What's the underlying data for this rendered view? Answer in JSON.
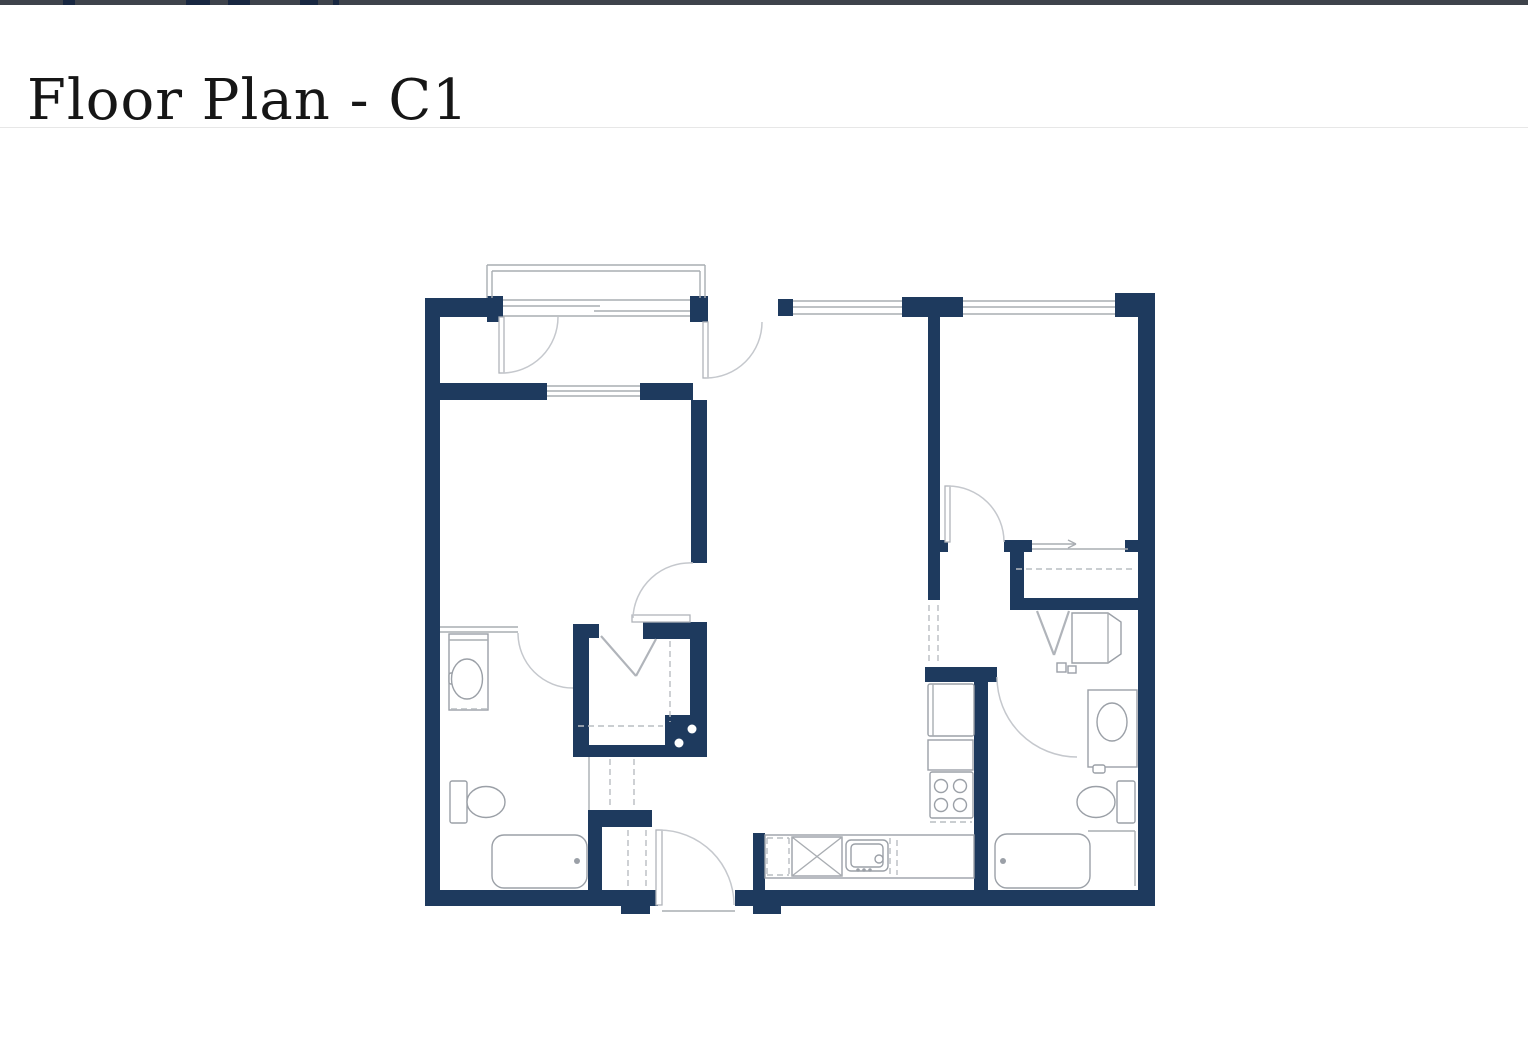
{
  "topbar": {
    "color": "#3e434b",
    "mark_color": "#182741",
    "marks": [
      [
        63,
        12
      ],
      [
        186,
        24
      ],
      [
        228,
        22
      ],
      [
        300,
        18
      ],
      [
        333,
        6
      ]
    ]
  },
  "header": {
    "title": "Floor Plan - C1"
  },
  "plan": {
    "colors": {
      "wall": "#1e3a5e",
      "line": "#a9adb2",
      "arc": "#c5c8cd",
      "dash": "#b9bdc2",
      "fixture": "#9ba0a7",
      "leaf": "#b0b4ba"
    },
    "walls": [
      [
        425,
        298,
        62,
        19
      ],
      [
        487,
        296,
        16,
        26
      ],
      [
        690,
        296,
        18,
        26
      ],
      [
        778,
        299,
        15,
        17
      ],
      [
        902,
        297,
        61,
        20
      ],
      [
        1115,
        293,
        40,
        24
      ],
      [
        425,
        298,
        15,
        608
      ],
      [
        1138,
        293,
        17,
        613
      ],
      [
        425,
        890,
        233,
        16
      ],
      [
        735,
        890,
        420,
        16
      ],
      [
        621,
        892,
        29,
        22
      ],
      [
        753,
        892,
        28,
        22
      ],
      [
        425,
        383,
        122,
        17
      ],
      [
        640,
        383,
        53,
        17
      ],
      [
        691,
        400,
        16,
        163
      ],
      [
        643,
        622,
        64,
        17
      ],
      [
        690,
        622,
        17,
        93
      ],
      [
        665,
        715,
        42,
        42
      ],
      [
        573,
        745,
        94,
        12
      ],
      [
        573,
        624,
        16,
        133
      ],
      [
        587,
        624,
        12,
        14
      ],
      [
        588,
        810,
        64,
        17
      ],
      [
        588,
        810,
        14,
        80
      ],
      [
        753,
        833,
        12,
        57
      ],
      [
        974,
        682,
        14,
        208
      ],
      [
        925,
        667,
        72,
        15
      ],
      [
        928,
        317,
        12,
        283
      ],
      [
        940,
        540,
        8,
        12
      ],
      [
        1004,
        540,
        28,
        12
      ],
      [
        1125,
        540,
        13,
        12
      ],
      [
        1010,
        552,
        14,
        58
      ],
      [
        1010,
        598,
        130,
        12
      ]
    ],
    "frects": [
      [
        449,
        634,
        39,
        76,
        0
      ],
      [
        449,
        673,
        8,
        11,
        2
      ],
      [
        450,
        781,
        17,
        42,
        2
      ],
      [
        492,
        835,
        95,
        53,
        12
      ],
      [
        765,
        835,
        209,
        43,
        0
      ],
      [
        792,
        837,
        50,
        39,
        0
      ],
      [
        846,
        840,
        42,
        31,
        5
      ],
      [
        851,
        844,
        32,
        23,
        4
      ],
      [
        928,
        684,
        46,
        52,
        2
      ],
      [
        928,
        740,
        45,
        30,
        0
      ],
      [
        930,
        772,
        43,
        46,
        2
      ],
      [
        1088,
        690,
        49,
        77,
        0
      ],
      [
        1093,
        765,
        12,
        8,
        2
      ],
      [
        1117,
        781,
        18,
        42,
        2
      ],
      [
        995,
        834,
        95,
        54,
        12
      ],
      [
        1057,
        663,
        9,
        9,
        0
      ],
      [
        1068,
        666,
        8,
        7,
        0
      ]
    ],
    "polys": [
      "1072,613 1108,613 1121,622 1121,654 1108,663 1072,663"
    ],
    "ellipses": [
      [
        467,
        679,
        15.5,
        20
      ],
      [
        486,
        802,
        19,
        15.5
      ],
      [
        1112,
        722,
        15,
        19
      ],
      [
        1096,
        802,
        19,
        15.5
      ],
      [
        941,
        786,
        6.5,
        6.5
      ],
      [
        960,
        786,
        6.5,
        6.5
      ],
      [
        941,
        805,
        6.5,
        6.5
      ],
      [
        960,
        805,
        6.5,
        6.5
      ],
      [
        879,
        859,
        4,
        4
      ]
    ],
    "leaves": [
      [
        632,
        615,
        58,
        7
      ],
      [
        656,
        830,
        6,
        75
      ],
      [
        499,
        317,
        5,
        56
      ],
      [
        703,
        322,
        5,
        56
      ],
      [
        945,
        486,
        5,
        56
      ]
    ],
    "lines": [
      [
        487,
        298,
        487,
        265
      ],
      [
        487,
        265,
        705,
        265
      ],
      [
        705,
        265,
        705,
        298
      ],
      [
        492,
        298,
        492,
        271
      ],
      [
        492,
        271,
        700,
        271
      ],
      [
        700,
        271,
        700,
        298
      ],
      [
        503,
        300,
        690,
        300
      ],
      [
        503,
        316,
        690,
        316
      ],
      [
        503,
        306,
        600,
        306
      ],
      [
        594,
        311,
        690,
        311
      ],
      [
        547,
        386,
        640,
        386
      ],
      [
        547,
        391,
        640,
        391
      ],
      [
        547,
        396,
        640,
        396
      ],
      [
        793,
        301,
        902,
        301
      ],
      [
        793,
        307,
        902,
        307
      ],
      [
        793,
        314,
        902,
        314
      ],
      [
        963,
        301,
        1115,
        301
      ],
      [
        963,
        307,
        1115,
        307
      ],
      [
        963,
        314,
        1115,
        314
      ],
      [
        440,
        627,
        518,
        627
      ],
      [
        440,
        632,
        518,
        632
      ],
      [
        589,
        757,
        589,
        810
      ],
      [
        1032,
        549,
        1128,
        549
      ],
      [
        1032,
        544,
        1076,
        544
      ],
      [
        1068,
        540,
        1076,
        544
      ],
      [
        1068,
        548,
        1076,
        544
      ],
      [
        1088,
        831,
        1135,
        831
      ],
      [
        1135,
        831,
        1135,
        886
      ],
      [
        662,
        911,
        735,
        911
      ],
      [
        792,
        837,
        842,
        876
      ],
      [
        842,
        837,
        792,
        876
      ],
      [
        933,
        684,
        933,
        736
      ],
      [
        1108,
        613,
        1108,
        663
      ],
      [
        449,
        640,
        488,
        640
      ]
    ],
    "vlines": [
      [
        601,
        636,
        636,
        676
      ],
      [
        636,
        676,
        656,
        639
      ],
      [
        1037,
        611,
        1054,
        655
      ],
      [
        1054,
        655,
        1069,
        611
      ]
    ],
    "dlines": [
      [
        929,
        605,
        929,
        665
      ],
      [
        938,
        605,
        938,
        665
      ],
      [
        578,
        726,
        663,
        726
      ],
      [
        670,
        641,
        670,
        722
      ],
      [
        1016,
        569,
        1135,
        569
      ],
      [
        610,
        759,
        610,
        808
      ],
      [
        634,
        759,
        634,
        808
      ],
      [
        628,
        830,
        628,
        888
      ],
      [
        646,
        830,
        646,
        888
      ],
      [
        451,
        709,
        487,
        709
      ],
      [
        890,
        838,
        890,
        875
      ],
      [
        897,
        840,
        897,
        875
      ],
      [
        930,
        822,
        972,
        822
      ],
      [
        767,
        838,
        789,
        838
      ],
      [
        767,
        875,
        789,
        875
      ],
      [
        767,
        838,
        767,
        875
      ],
      [
        789,
        838,
        789,
        875
      ]
    ],
    "arcs": [
      "M502,373 A56,56 0 0 0 558,317",
      "M706,378 A56,56 0 0 0 762,322",
      "M693,563 A57,57 0 0 0 633,618",
      "M518,633 A55,55 0 0 0 573,688",
      "M948,486 A56,56 0 0 1 1004,542",
      "M997,677 A80,80 0 0 0 1077,757",
      "M659,830 A75,75 0 0 1 734,905"
    ],
    "dots": [
      [
        577,
        861,
        3
      ],
      [
        1003,
        861,
        3
      ],
      [
        858,
        870,
        1.8
      ],
      [
        864,
        870,
        1.8
      ],
      [
        870,
        870,
        1.8
      ]
    ],
    "white_dots": [
      [
        679,
        743,
        4.5
      ],
      [
        692,
        729,
        4.5
      ]
    ]
  }
}
